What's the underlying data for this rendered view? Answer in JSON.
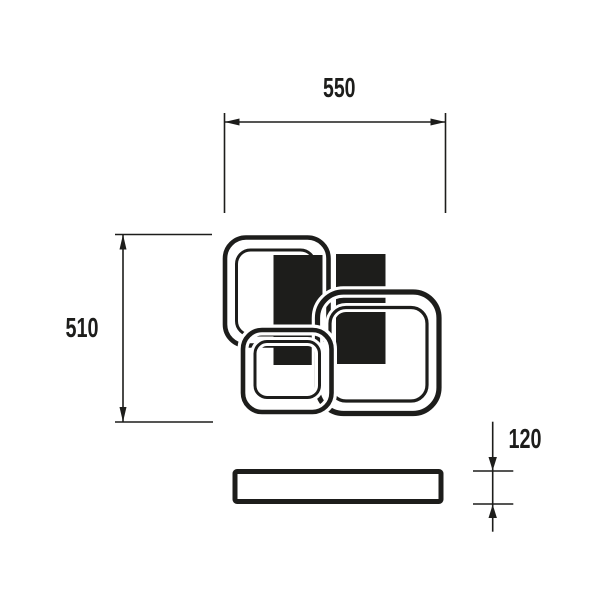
{
  "colors": {
    "ink": "#1d1d1b",
    "paper": "#ffffff"
  },
  "dimensions": {
    "width": {
      "label": "550"
    },
    "height": {
      "label": "510"
    },
    "depth": {
      "label": "120"
    }
  }
}
